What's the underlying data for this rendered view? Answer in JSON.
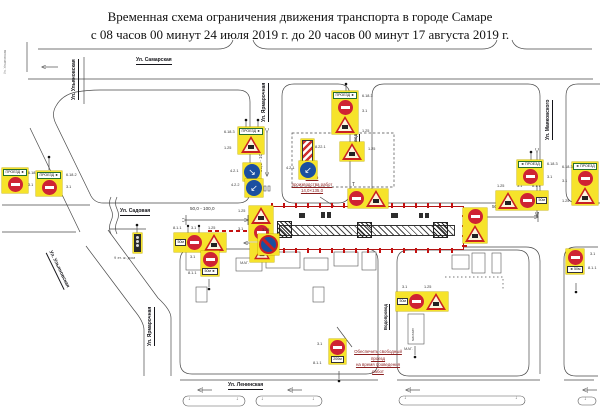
{
  "title": {
    "line1": "Временная схема ограничения движения транспорта в городе Самаре",
    "line2": "с 08 часов 00 минут 24 июля 2019 г. до 20 часов 00 минут 17 августа 2019 г."
  },
  "streets": {
    "samarskaya": "Ул. Самарская",
    "sadovaya": "Ул. Садовая",
    "leninskaya": "Ул. Ленинская",
    "ulyanovskaya": "Ул. Ульяновская",
    "yarmarochnaya": "Ул. Ярмарочная",
    "mayakovskogo": "Ул. Маяковского",
    "vodoprovod": "Водопровод"
  },
  "worksite": {
    "line1": "Место",
    "line2": "производства работ",
    "line3": "14,0×135,0"
  },
  "note": {
    "line1": "Обеспечить свободный проезд",
    "line2": "на время проведения работ"
  },
  "dim": {
    "range": "50,0 - 100,0"
  },
  "plates": {
    "m50": "50м",
    "m200": "200м",
    "m50_left": "◄ 50м",
    "m50_right": "50м ►",
    "detour_right": "ПРОЕЗД ►",
    "detour_left": "◄ ПРОЕЗД"
  },
  "codes": {
    "c31": "3.1",
    "c125": "1.25",
    "c421": "4.2.1",
    "c422": "4.2.2",
    "c811": "8.1.1",
    "c328": "3.28",
    "c6182": "6.18.2",
    "c6183": "6.18.3",
    "c8221": "8.22.1"
  },
  "labels": {
    "t_light": "Т"
  },
  "buildings": {
    "mag": "МАГ.",
    "shop": "магазин",
    "dom9": "9 эт. ж. дом"
  },
  "icons": {
    "detour_right_arrow": "↘",
    "detour_left_arrow": "↙",
    "down_arrow": "↓"
  },
  "colors": {
    "sign_yellow": "#f6e32b",
    "no_entry_red": "#cf2333",
    "work_zone_red": "#b31414",
    "blue_sign": "#1b4fa0",
    "arrow_blue": "#2b62c4",
    "note_red": "#8b2020"
  }
}
